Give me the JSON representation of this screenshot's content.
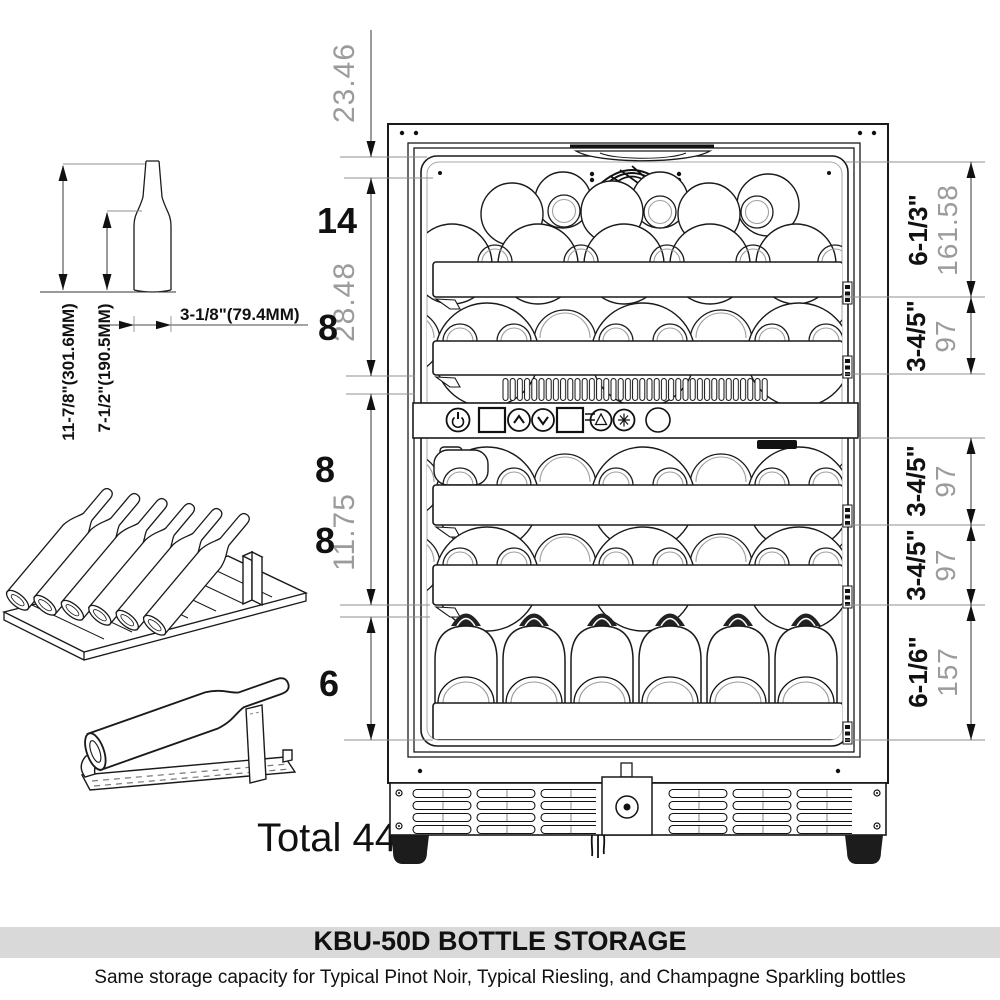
{
  "footer": {
    "title": "KBU-50D BOTTLE STORAGE",
    "subtitle": "Same storage capacity for Typical Pinot Noir, Typical Riesling, and Champagne Sparkling bottles"
  },
  "totals": {
    "label": "Total 44"
  },
  "bottle_spec": {
    "height": "11-7/8\"(301.6MM)",
    "body_height": "7-1/2\"(190.5MM)",
    "diameter": "3-1/8\"(79.4MM)"
  },
  "left_dims": {
    "top_gap": "23.46",
    "upper": "28.48",
    "middle": "11.75"
  },
  "counts": {
    "row1": "14",
    "row2": "8",
    "row3": "8",
    "row4": "8",
    "row5": "6"
  },
  "right_dims": {
    "s1_in": "6-1/3\"",
    "s1_mm": "161.58",
    "s2_in": "3-4/5\"",
    "s2_mm": "97",
    "s3_in": "3-4/5\"",
    "s3_mm": "97",
    "s4_in": "3-4/5\"",
    "s4_mm": "97",
    "s5_in": "6-1/6\"",
    "s5_mm": "157"
  },
  "colors": {
    "line": "#1a1a1a",
    "dim_gray": "#9b9b9b",
    "title_bg": "#d9d9d9"
  }
}
